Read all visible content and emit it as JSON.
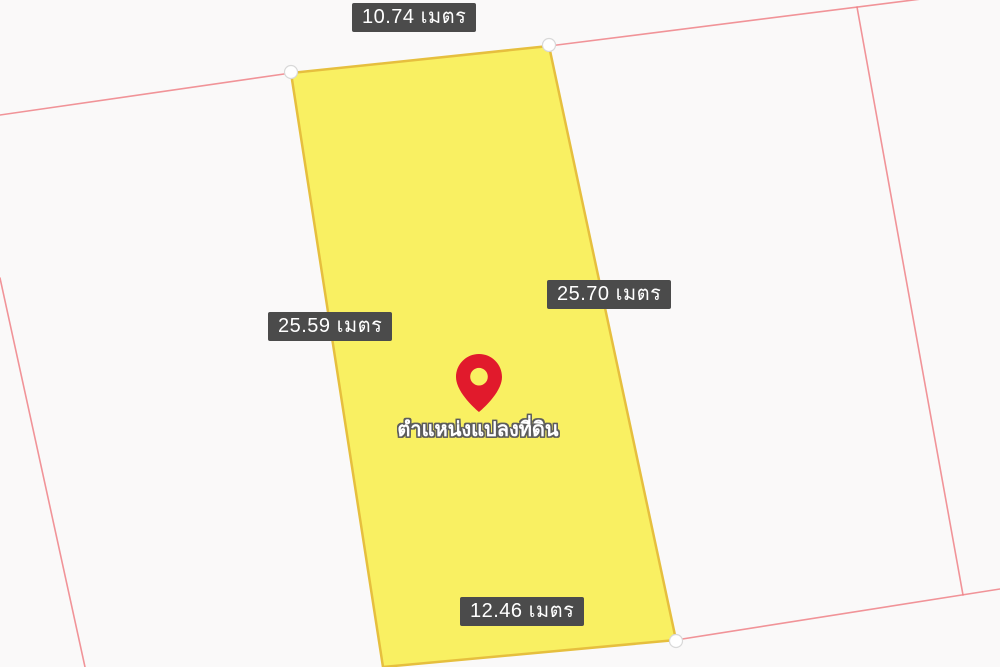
{
  "page": {
    "background_color": "#faf9f9"
  },
  "map": {
    "parcel": {
      "points": "291,73 549,46 676,640 383,667",
      "fill": "#f9ef55",
      "stroke": "#e6bf3e"
    },
    "boundary_lines": {
      "color": "#ee8187",
      "segments": [
        {
          "d": "M0,115 L291,73"
        },
        {
          "d": "M549,46 L945,-4"
        },
        {
          "d": "M857,7 L963,595"
        },
        {
          "d": "M676,640 L1000,589"
        },
        {
          "d": "M0,278 L85,667"
        }
      ]
    },
    "vertex_markers": [
      {
        "cx": "291",
        "cy": "72"
      },
      {
        "cx": "549",
        "cy": "45"
      },
      {
        "cx": "676",
        "cy": "641"
      }
    ],
    "dimension_labels": [
      {
        "position": "top",
        "text": "10.74 เมตร"
      },
      {
        "position": "right",
        "text": "25.70 เมตร"
      },
      {
        "position": "left",
        "text": "25.59 เมตร"
      },
      {
        "position": "bottom",
        "text": "12.46 เมตร"
      }
    ],
    "label_colors": {
      "background": "#4b4b4b",
      "text": "#ffffff"
    },
    "marker": {
      "pin_color": "#e11a2c",
      "pin_hole_color": "#ffffff",
      "caption": "ตำแหน่งแปลงที่ดิน"
    }
  }
}
